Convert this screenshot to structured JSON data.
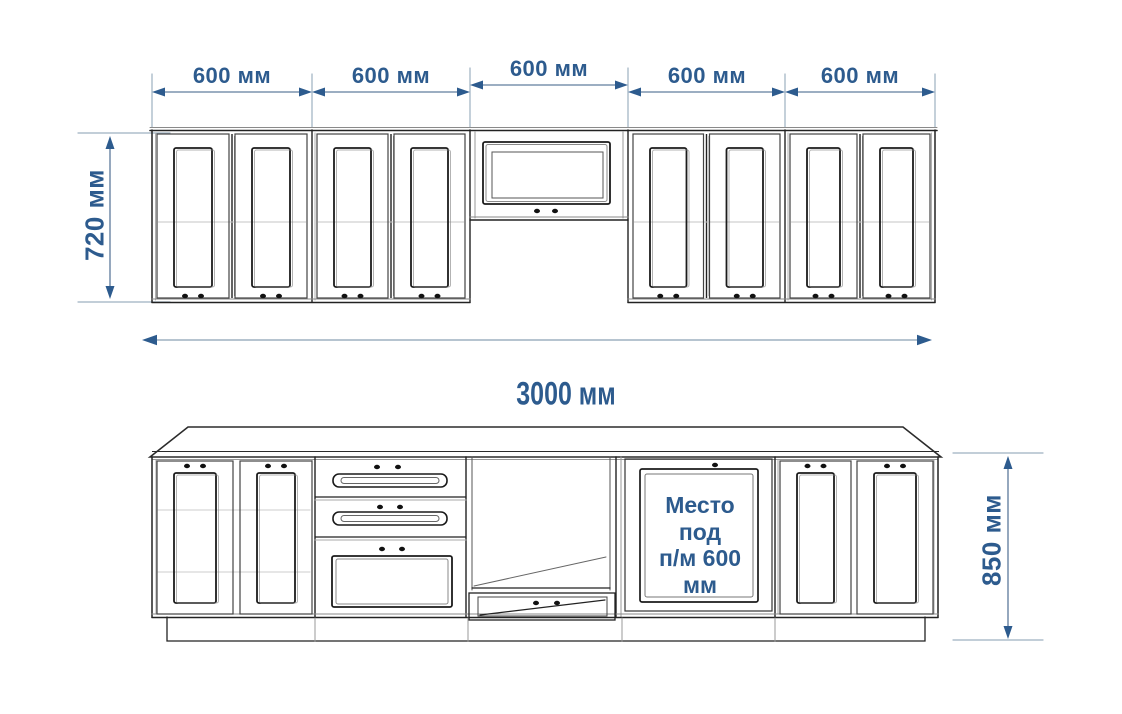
{
  "colors": {
    "dimension_text": "#2d5b8e",
    "dimension_arrow": "#2d5b8e",
    "dimension_line": "#7b93ad",
    "extension_line": "#9db0c0",
    "linework_dark": "#222222",
    "linework_light": "#999999",
    "background": "#ffffff"
  },
  "dimensions": {
    "upper_widths": [
      "600 мм",
      "600 мм",
      "600 мм",
      "600 мм",
      "600 мм"
    ],
    "upper_cabinet_height": "720 мм",
    "total_width": "3000 мм",
    "base_cabinet_height": "850 мм"
  },
  "annotations": {
    "dishwasher_space_lines": [
      "Место",
      "под",
      "п/м 600",
      "мм"
    ]
  }
}
